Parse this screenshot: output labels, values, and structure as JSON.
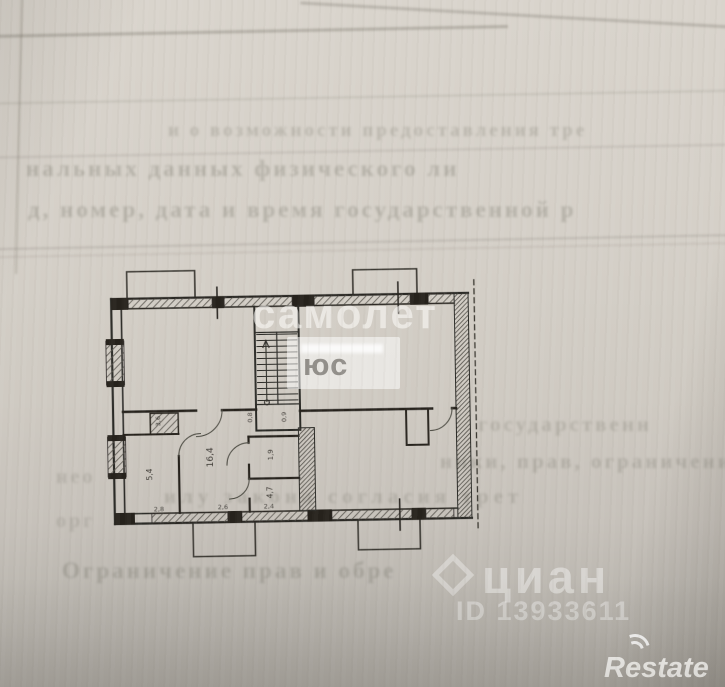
{
  "watermarks": {
    "samolet": {
      "text": "самолет",
      "plus_label": "юс"
    },
    "cian": {
      "text": "циан",
      "id_text": "ID 13933611"
    },
    "restate": {
      "text": "Restate"
    }
  },
  "bleedthrough": {
    "lines": [
      {
        "text": "и о возможности предоставления тре"
      },
      {
        "text": "нальных данных физического ли"
      },
      {
        "text": "д, номер, дата и время государственной р"
      },
      {
        "text": "государственн"
      },
      {
        "text": "ники, прав, ограничения пра"
      },
      {
        "text": "илу закона согласия трет"
      },
      {
        "text": "нео"
      },
      {
        "text": "орг"
      },
      {
        "text": "Ограничение прав и обре"
      }
    ]
  },
  "plan": {
    "room_labels": [
      "3,6",
      "5,4",
      "16,4",
      "1,9",
      "4,7"
    ],
    "dim_labels": [
      "2,8",
      "2,6",
      "2,4",
      "0,8",
      "0,9"
    ],
    "line_color": "#2b2925"
  }
}
